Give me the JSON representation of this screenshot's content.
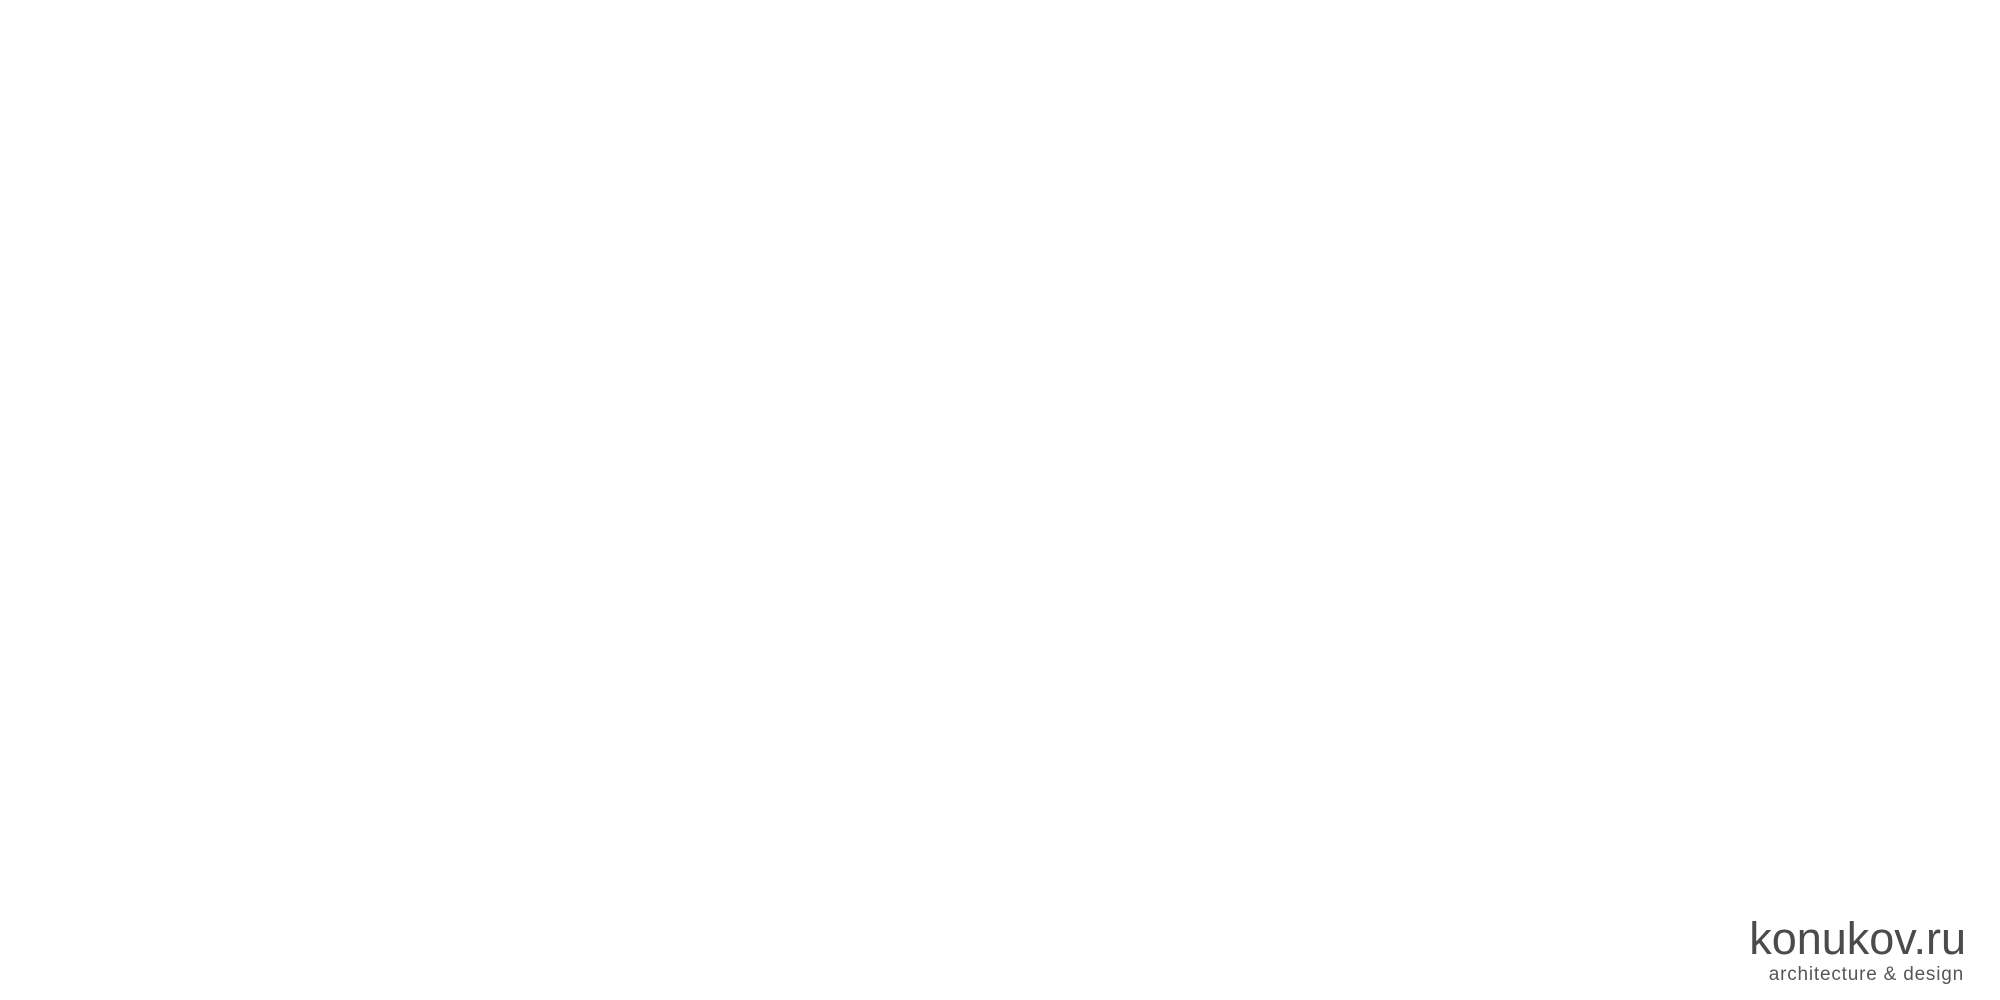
{
  "canvas": {
    "w": 2000,
    "h": 1000,
    "bg": "#ffffff"
  },
  "logo": {
    "title": "konukov.ru",
    "subtitle": "architecture & design"
  },
  "watermark": {
    "line1": "konukov.ru",
    "line2": "architecture & design",
    "color": "#f6f6f6",
    "opacity": 0.92,
    "grid": {
      "x0": 194,
      "y0": 118,
      "dx": 428,
      "dy": 131,
      "stagger": 214,
      "rows": 7,
      "cols": 5
    }
  },
  "palette": {
    "white": "#fcfcfc",
    "outline": "#aeaeae",
    "gray": "#a8a8a8",
    "wall": "#b0b0b0",
    "wallLow": "#a4a4a4",
    "window": "#6f6f6f",
    "mullion": "#4a4a4a",
    "dark": "#3a3a3a",
    "roofEdge": "#8e8e8e",
    "roofLine": "#b5b5b5",
    "side": "#9c9c9c",
    "hatchBg": "#ececec",
    "hatchLine": "#9b9b9b",
    "shadow": "#a8a8a8"
  },
  "scene": {
    "whites": [
      {
        "name": "ground-apron-northeast",
        "path": "M1180,95 L1503,285 L1390,360 L1080,170 Z"
      },
      {
        "name": "entry-plaza",
        "path": "M520,336 L640,266 L790,350 L680,430 L565,361 Z"
      },
      {
        "name": "left-driveway",
        "path": "M108,573 L520,336 L565,361 L152,598 Z"
      },
      {
        "name": "main-driveway",
        "path": "M905,345 L950,312 L1285,490 Q1338,518 1374,484 L1528,267 L1570,243 L715,953 L672,930 L1258,568 Z"
      }
    ],
    "grays": [
      {
        "name": "left-driveway-shoulder",
        "path": "M150,597 L600,382 L617,392 L167,608 Z"
      },
      {
        "name": "left-driveway-endcap",
        "path": "M108,573 L150,597 L97,628 L55,604 Z"
      },
      {
        "name": "facade-ground-shadow",
        "path": "M445,288 L800,478 L737,524 L382,334 Z"
      },
      {
        "name": "east-wing-ground-shadow",
        "path": "M1060,275 L1336,426 L1252,489 L976,339 Z"
      },
      {
        "name": "junction-shadow-band",
        "path": "M1528,267 L1372,487 L1340,464 L1496,244 Z"
      },
      {
        "name": "court-driveway-shadow-band",
        "path": "M905,345 L1258,568 L1198,614 L845,391 Z"
      },
      {
        "name": "main-driveway-shoulder",
        "path": "M1570,243 L1584,252 L729,962 L715,953 Z"
      },
      {
        "name": "main-driveway-endcap",
        "path": "M672,930 L715,953 L661,984 L618,961 Z"
      }
    ],
    "roofs": [
      {
        "name": "roof-north",
        "L": [
          714,
          77
        ],
        "T": [
          843,
          9
        ],
        "R": [
          972,
          77
        ],
        "B": [
          843,
          145
        ],
        "apex": [
          843,
          77
        ]
      },
      {
        "name": "roof-east",
        "L": [
          976,
          198
        ],
        "T": [
          1156,
          97
        ],
        "R": [
          1336,
          187
        ],
        "B": [
          1156,
          288
        ],
        "apex": [
          1156,
          193
        ]
      },
      {
        "name": "roof-northwest",
        "L": [
          402,
          291
        ],
        "T": [
          701,
          80
        ],
        "R": [
          881,
          170
        ],
        "B": [
          582,
          381
        ],
        "apex": [
          641,
          230
        ]
      },
      {
        "name": "roof-west",
        "L": [
          492,
          282
        ],
        "T": [
          627,
          188
        ],
        "R": [
          797,
          273
        ],
        "B": [
          662,
          367
        ],
        "apex": [
          650,
          277
        ]
      },
      {
        "name": "roof-south",
        "L": [
          558,
          338
        ],
        "T": [
          693,
          244
        ],
        "R": [
          863,
          329
        ],
        "B": [
          728,
          423
        ],
        "apex": [
          715,
          333
        ]
      }
    ],
    "walls": [
      {
        "name": "upper-facade-wall",
        "path": "M497,292 L728,425 L728,459 L497,326 Z",
        "fill": "wall"
      },
      {
        "name": "upper-facade-window-1",
        "path": "M515,310 L562,337 L562,356 L515,329 Z",
        "fill": "window"
      },
      {
        "name": "upper-facade-window-2",
        "path": "M575,345 L622,372 L622,391 L575,364 Z",
        "fill": "window"
      },
      {
        "name": "upper-facade-window-3",
        "path": "M635,380 L682,407 L682,426 L635,399 Z",
        "fill": "window"
      },
      {
        "name": "interfloor-fascia",
        "path": "M452,312 L770,490 L770,497 L452,319 Z",
        "fill": "white"
      },
      {
        "name": "lower-facade-wall",
        "path": "M455,318 L768,494 L768,530 L455,354 Z",
        "fill": "wallLow"
      },
      {
        "name": "lower-facade-glazing",
        "path": "M470,336 L750,494 L750,516 L470,358 Z",
        "fill": "window"
      },
      {
        "name": "courtyard-corridor-glazing",
        "path": "M742,350 L1038,205 L1052,228 L756,373 Z",
        "fill": "hatchBg"
      },
      {
        "name": "courtyard-corridor-darkband",
        "path": "M748,352 L1040,209 L1046,219 L754,362 Z",
        "fill": "dark"
      }
    ],
    "pools": [
      {
        "name": "courtyard-pool",
        "path": "M950,315 L1005,285 L1060,315 L1005,345 Z"
      },
      {
        "name": "courtyard-pool-step1",
        "path": "M962,315 L1005,292 L1048,315 L1005,338 Z"
      },
      {
        "name": "courtyard-pool-step2",
        "path": "M974,315 L1005,299 L1036,315 L1005,331 Z"
      },
      {
        "name": "courtyard-spa-frame",
        "path": "M948,376 L966,366 L984,376 L966,386 Z"
      }
    ],
    "terrace": {
      "name": "courtyard-terrace-paving",
      "path": "M920,345 L958,323 L996,345 L958,367 Z"
    },
    "lines": [
      {
        "name": "terrace-step-line-1",
        "path": "M880,372 L940,338",
        "w": 1
      },
      {
        "name": "terrace-step-line-2",
        "path": "M890,380 L950,346",
        "w": 1
      },
      {
        "name": "terrace-step-line-3",
        "path": "M900,388 L960,354",
        "w": 1
      },
      {
        "name": "glazing-mullions",
        "path": "M500,355 L500,338 M530,372 L530,355 M560,389 L560,372 M590,406 L590,389 M620,423 L620,406 M650,440 L650,423 M680,457 L680,440 M710,474 L710,457",
        "w": 1.5
      }
    ],
    "boxes": [
      {
        "name": "chimney-north-junction",
        "cx": 925,
        "cy": 118,
        "len": 52,
        "wid": 26,
        "h": 38,
        "hatch": 1
      },
      {
        "name": "chimney-north",
        "cx": 1028,
        "cy": 40,
        "len": 44,
        "wid": 22,
        "h": 30,
        "hatch": 1
      },
      {
        "name": "chimney-east",
        "cx": 1258,
        "cy": 170,
        "len": 54,
        "wid": 26,
        "h": 34,
        "hatch": 1
      },
      {
        "name": "chimney-center",
        "cx": 818,
        "cy": 212,
        "len": 62,
        "wid": 30,
        "h": 46,
        "hatch": 1
      },
      {
        "name": "chimney-south-west",
        "cx": 648,
        "cy": 418,
        "len": 52,
        "wid": 26,
        "h": 36,
        "hatch": 1
      },
      {
        "name": "chimney-courtyard",
        "cx": 808,
        "cy": 420,
        "len": 50,
        "wid": 24,
        "h": 30,
        "hatch": 1
      },
      {
        "name": "skylight-west-roof",
        "cx": 672,
        "cy": 326,
        "len": 64,
        "wid": 40,
        "h": 14,
        "hatch": 0
      },
      {
        "name": "skylight-northwest-roof",
        "cx": 644,
        "cy": 166,
        "len": 40,
        "wid": 26,
        "h": 10,
        "hatch": 0
      }
    ],
    "vents": [
      {
        "name": "roof-vent-1",
        "x": 712,
        "y": 273
      },
      {
        "name": "roof-vent-2",
        "x": 724,
        "y": 268
      }
    ]
  }
}
